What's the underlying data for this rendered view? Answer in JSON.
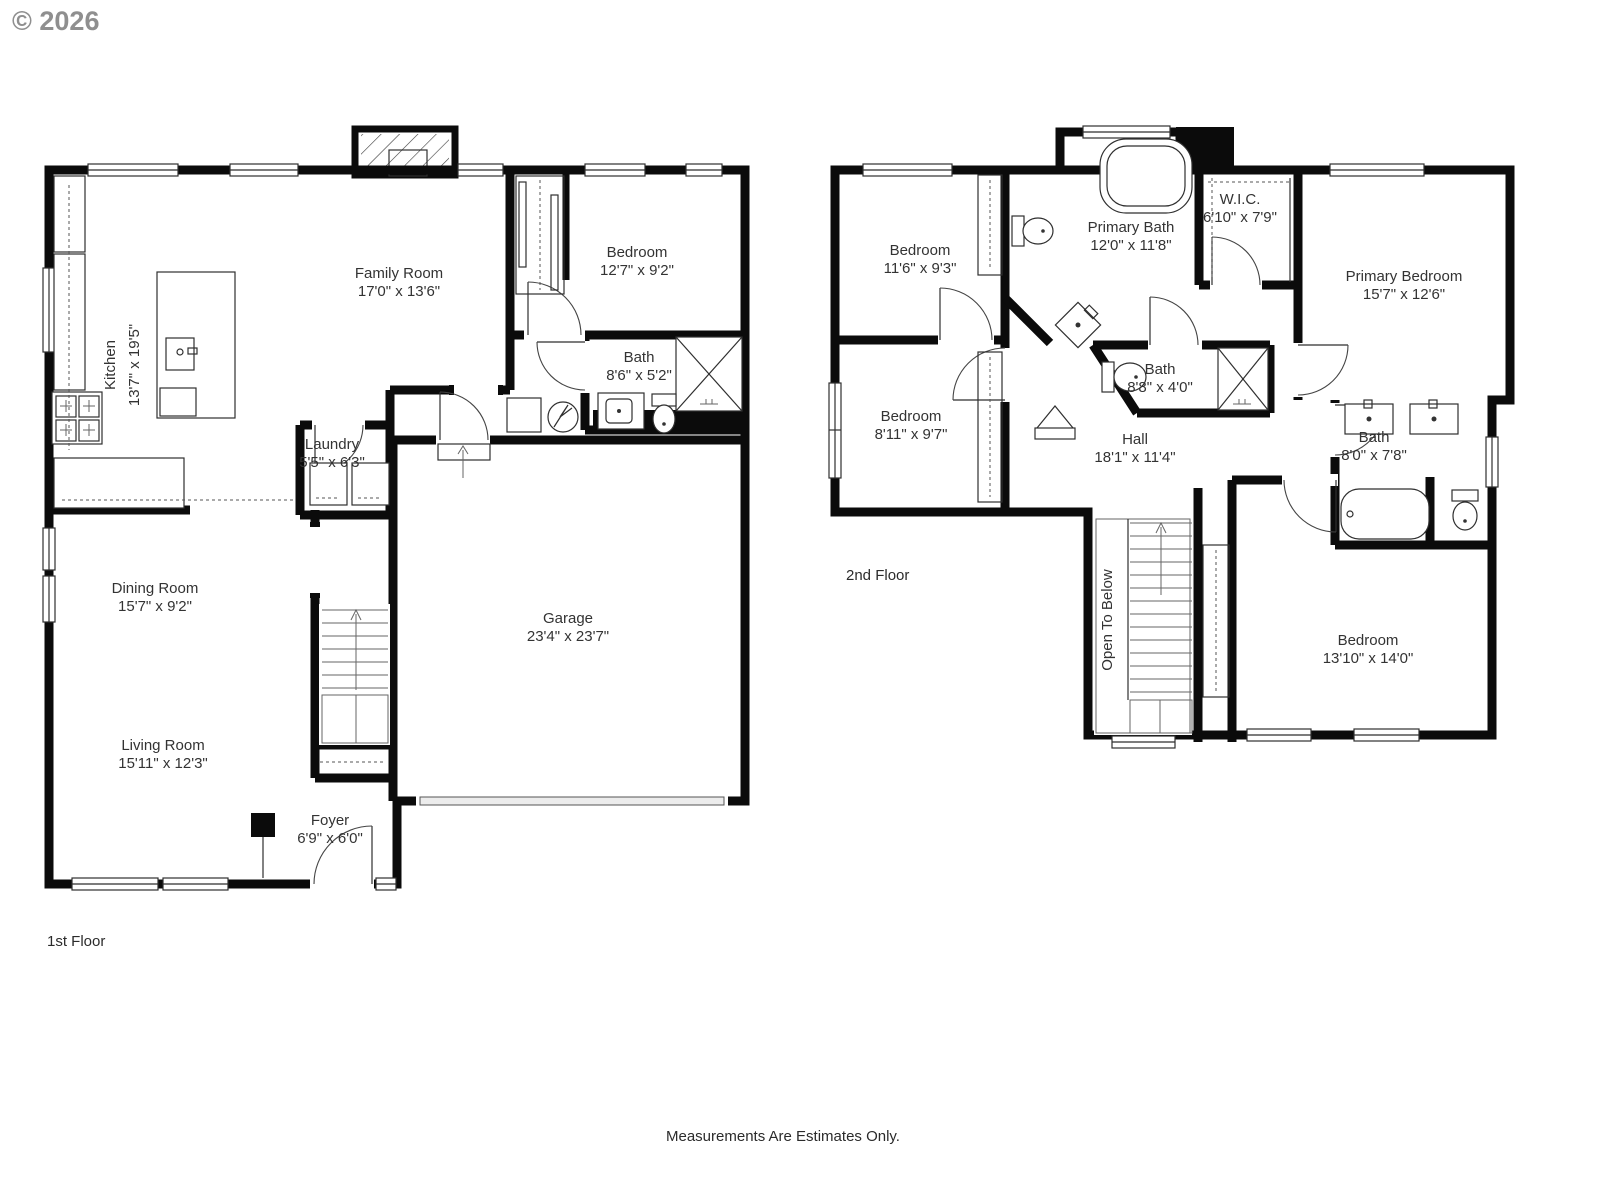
{
  "meta": {
    "copyright": "© 2026",
    "footer": "Measurements Are Estimates Only."
  },
  "floors": [
    {
      "label": "1st Floor",
      "rooms": [
        {
          "name": "Kitchen",
          "dims": "13'7\" x 19'5\""
        },
        {
          "name": "Family Room",
          "dims": "17'0\" x 13'6\""
        },
        {
          "name": "Bedroom",
          "dims": "12'7\" x 9'2\""
        },
        {
          "name": "Bath",
          "dims": "8'6\" x 5'2\""
        },
        {
          "name": "Laundry",
          "dims": "5'5\" x 6'3\""
        },
        {
          "name": "Dining Room",
          "dims": "15'7\" x 9'2\""
        },
        {
          "name": "Living Room",
          "dims": "15'11\" x 12'3\""
        },
        {
          "name": "Foyer",
          "dims": "6'9\" x 6'0\""
        },
        {
          "name": "Garage",
          "dims": "23'4\" x 23'7\""
        }
      ]
    },
    {
      "label": "2nd Floor",
      "rooms": [
        {
          "name": "Bedroom",
          "dims": "11'6\" x 9'3\""
        },
        {
          "name": "Primary Bath",
          "dims": "12'0\" x 11'8\""
        },
        {
          "name": "W.I.C.",
          "dims": "6'10\" x 7'9\""
        },
        {
          "name": "Primary Bedroom",
          "dims": "15'7\" x 12'6\""
        },
        {
          "name": "Bedroom",
          "dims": "8'11\" x 9'7\""
        },
        {
          "name": "Bath",
          "dims": "8'8\" x 4'0\""
        },
        {
          "name": "Hall",
          "dims": "18'1\" x 11'4\""
        },
        {
          "name": "Bath",
          "dims": "8'0\" x 7'8\""
        },
        {
          "name": "Bedroom",
          "dims": "13'10\" x 14'0\""
        }
      ],
      "annotations": [
        {
          "text": "Open To Below"
        }
      ]
    }
  ]
}
